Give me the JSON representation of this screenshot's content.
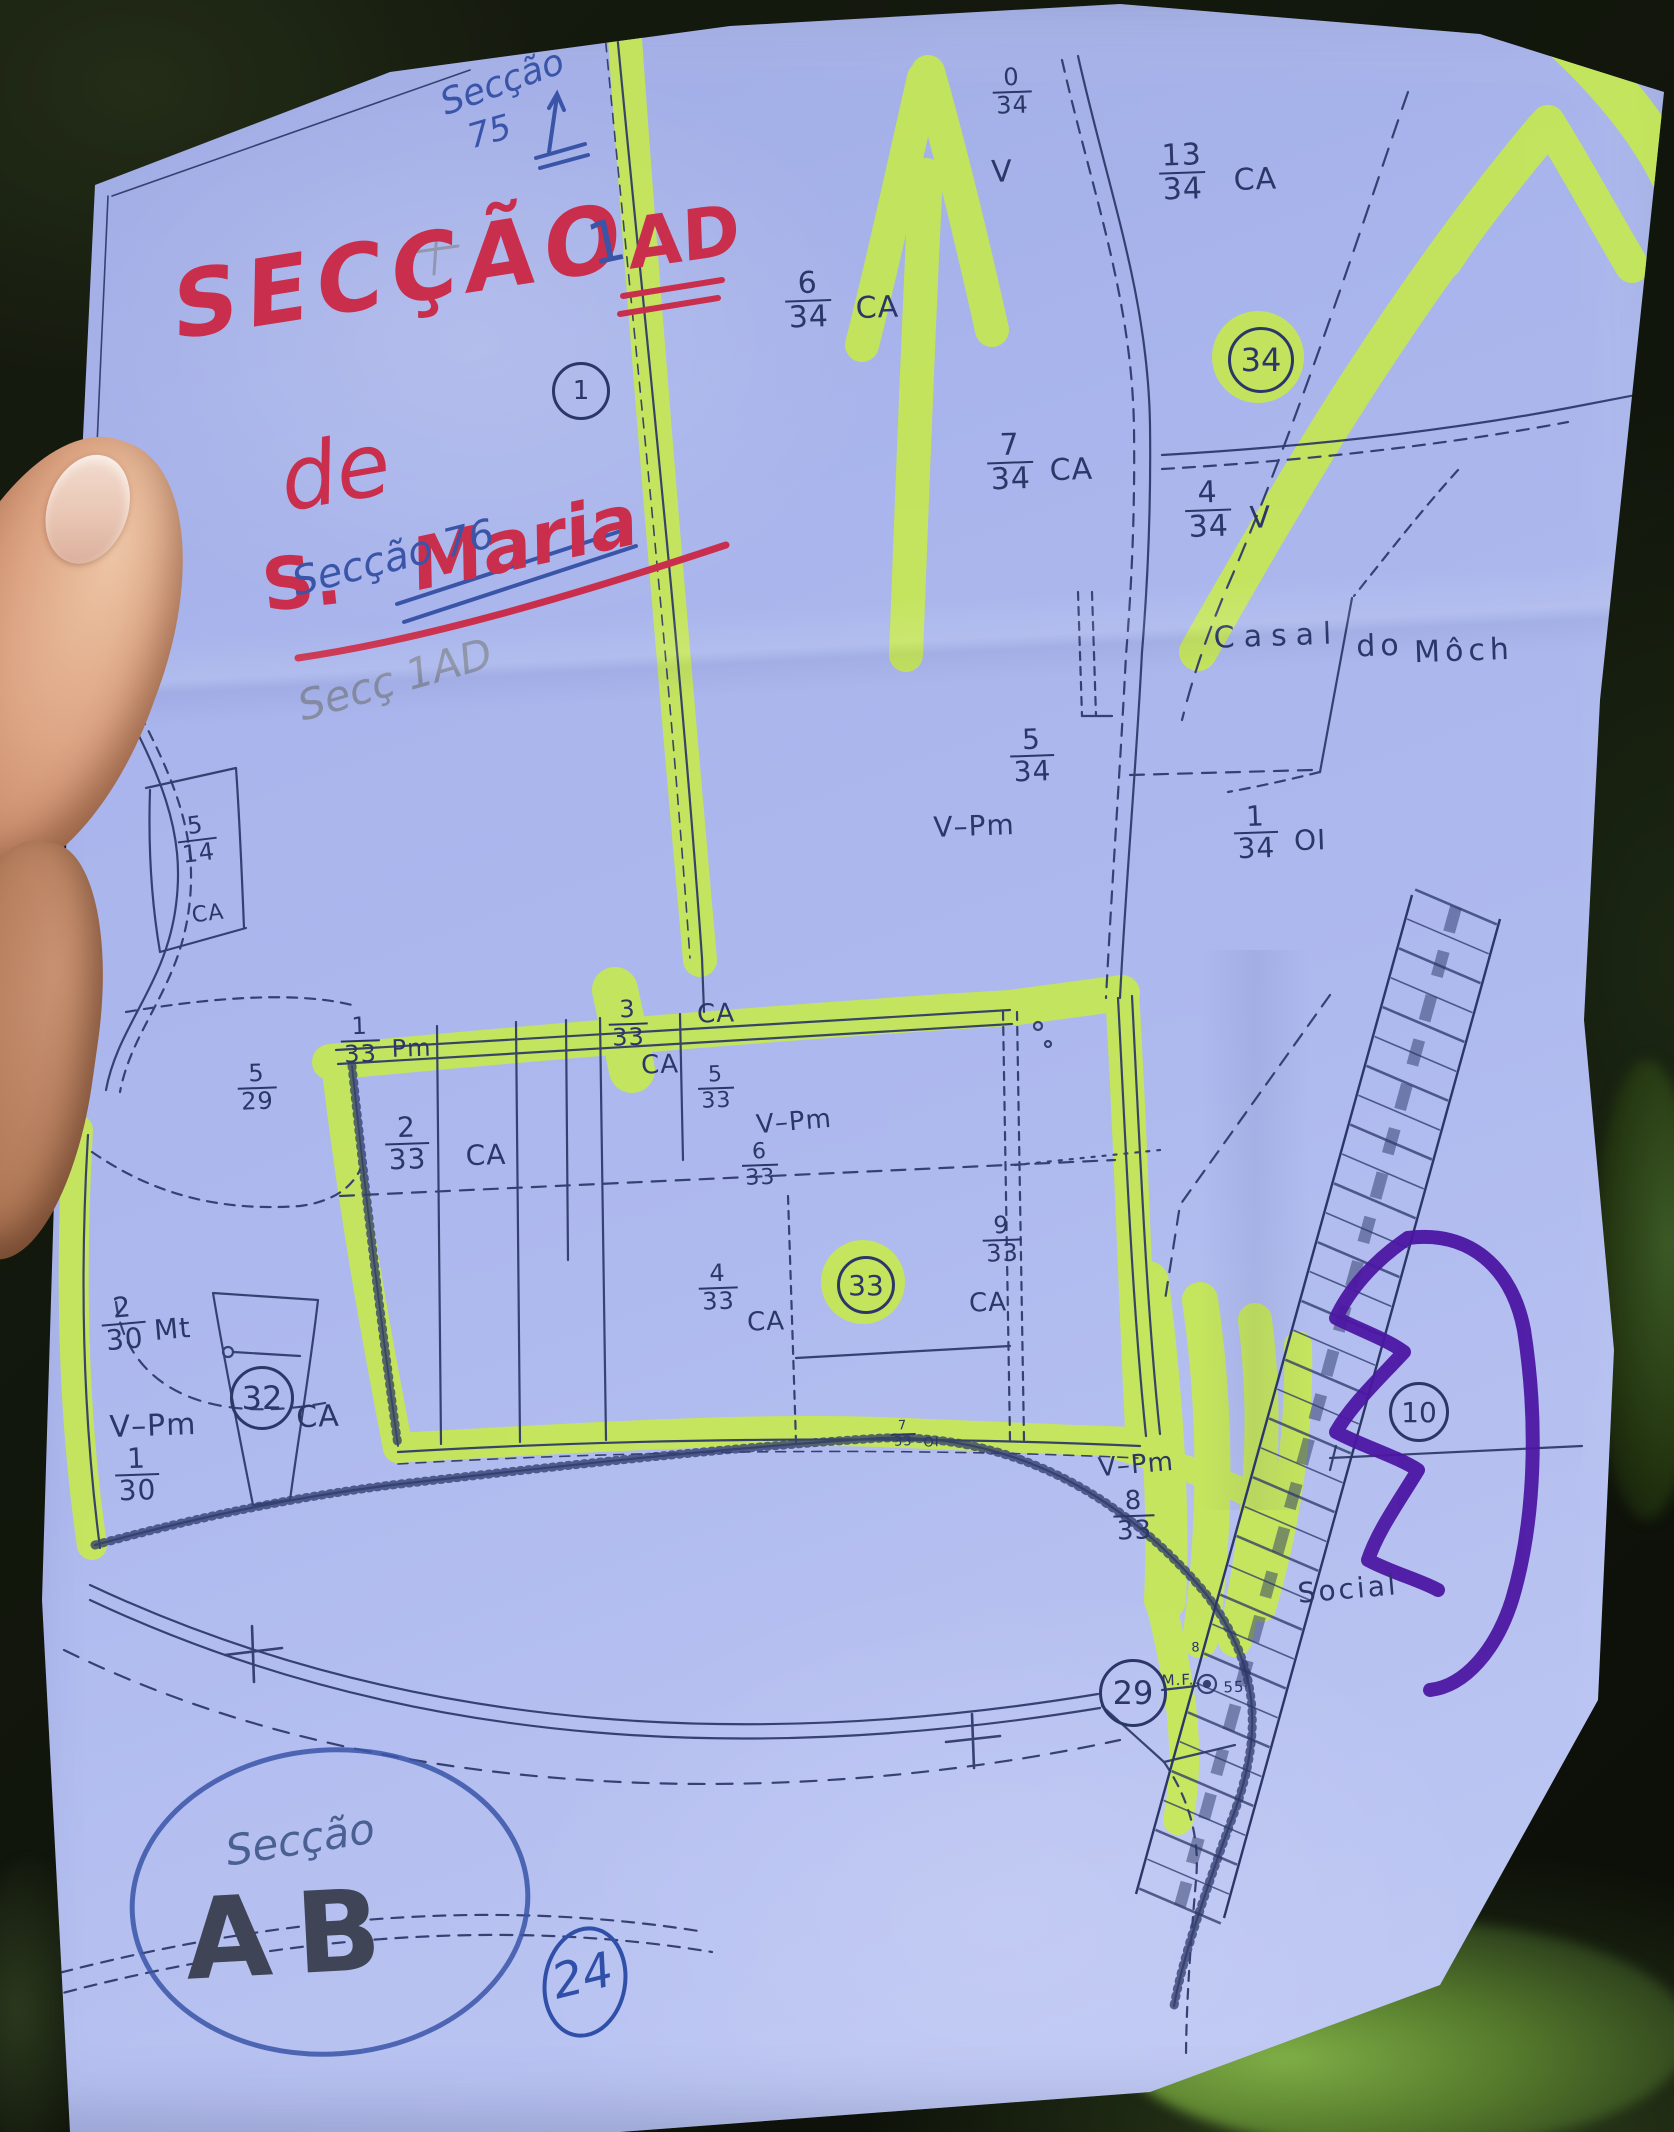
{
  "scene": {
    "description": "hand holding paper cadastral map photographed outdoors",
    "colors": {
      "paper": "#aab6ee",
      "map_ink": "#2c3768",
      "highlighter": "#c9ee3f",
      "purple_marker": "#4b16a3",
      "red_pen": "#c92f4c",
      "blue_pen": "#3a55a8",
      "pencil": "#828899",
      "background_foliage": "#141a10",
      "skin": "#d9a287"
    }
  },
  "annotations": {
    "red_title": "SECÇÃO",
    "blue_one": "1",
    "red_ad": "AD",
    "red_de": "de",
    "red_s": "S.",
    "red_maria": "Maria",
    "blue_top_word": "Secção",
    "blue_top_num": "75",
    "blue_mid": "Secção 76",
    "pencil_note": "Secç 1AD",
    "bottom_secao": "Secção",
    "bottom_ab": "AB",
    "bottom_24": "24"
  },
  "map": {
    "labels": [
      {
        "n": "0",
        "d": "34",
        "x": 1012,
        "y": 92,
        "fs": 24
      },
      {
        "t": "V",
        "x": 1002,
        "y": 172,
        "fs": 30
      },
      {
        "n": "13",
        "d": "34",
        "s": "CA",
        "x": 1218,
        "y": 172,
        "fs": 30,
        "gap": 28
      },
      {
        "n": "6",
        "d": "34",
        "s": "CA",
        "x": 842,
        "y": 300,
        "fs": 30,
        "gap": 24
      },
      {
        "n": "7",
        "d": "34",
        "s": "CA",
        "x": 1040,
        "y": 462,
        "fs": 30,
        "gap": 16
      },
      {
        "n": "4",
        "d": "34",
        "s": "V",
        "x": 1228,
        "y": 510,
        "fs": 30,
        "gap": 18
      },
      {
        "n": "5",
        "d": "34",
        "x": 1032,
        "y": 756,
        "fs": 28
      },
      {
        "t": "V–Pm",
        "x": 974,
        "y": 826,
        "fs": 28
      },
      {
        "n": "1",
        "d": "34",
        "s": "OI",
        "x": 1280,
        "y": 832,
        "fs": 28,
        "gap": 16
      },
      {
        "n": "5",
        "d": "14",
        "x": 197,
        "y": 840,
        "fs": 24,
        "rot": -7
      },
      {
        "t": "CA",
        "x": 208,
        "y": 914,
        "fs": 22,
        "rot": -7
      },
      {
        "n": "5",
        "d": "29",
        "x": 257,
        "y": 1088,
        "fs": 24
      },
      {
        "n": "1",
        "d": "33",
        "s": "Pm",
        "x": 386,
        "y": 1040,
        "fs": 24,
        "gap": 12
      },
      {
        "n": "2",
        "d": "33",
        "x": 407,
        "y": 1144,
        "fs": 28
      },
      {
        "t": "CA",
        "x": 486,
        "y": 1155,
        "fs": 28
      },
      {
        "n": "3",
        "d": "33",
        "x": 628,
        "y": 1024,
        "fs": 24
      },
      {
        "t": "CA",
        "x": 716,
        "y": 1014,
        "fs": 26
      },
      {
        "t": "CA",
        "x": 660,
        "y": 1065,
        "fs": 26
      },
      {
        "n": "5",
        "d": "33",
        "x": 716,
        "y": 1088,
        "fs": 22
      },
      {
        "t": "V–Pm",
        "x": 794,
        "y": 1122,
        "fs": 26,
        "rot": -5
      },
      {
        "n": "6",
        "d": "33",
        "x": 760,
        "y": 1165,
        "fs": 22
      },
      {
        "n": "9",
        "d": "33",
        "x": 1002,
        "y": 1240,
        "fs": 24
      },
      {
        "t": "CA",
        "x": 988,
        "y": 1303,
        "fs": 26
      },
      {
        "n": "4",
        "d": "33",
        "x": 718,
        "y": 1288,
        "fs": 24
      },
      {
        "t": "CA",
        "x": 766,
        "y": 1322,
        "fs": 26
      },
      {
        "n": "7",
        "d": "33",
        "s": "OI",
        "x": 915,
        "y": 1434,
        "fs": 13,
        "gap": 8
      },
      {
        "t": "V–Pm",
        "x": 1136,
        "y": 1465,
        "fs": 26,
        "rot": -5
      },
      {
        "n": "8",
        "d": "33",
        "x": 1134,
        "y": 1516,
        "fs": 26
      },
      {
        "n": "2",
        "d": "30",
        "s": "Mt",
        "x": 146,
        "y": 1322,
        "fs": 28,
        "gap": 8,
        "rot": -5
      },
      {
        "t": "CA",
        "x": 318,
        "y": 1417,
        "fs": 30
      },
      {
        "t": "V–Pm",
        "x": 153,
        "y": 1426,
        "fs": 30
      },
      {
        "n": "1",
        "d": "30",
        "x": 137,
        "y": 1475,
        "fs": 28
      },
      {
        "t": "Social",
        "x": 1348,
        "y": 1589,
        "fs": 28,
        "ls": 3,
        "rot": -5
      },
      {
        "t": "M.F.",
        "x": 1178,
        "y": 1680,
        "fs": 15
      },
      {
        "t": "55",
        "x": 1234,
        "y": 1687,
        "fs": 15
      },
      {
        "t": "8",
        "x": 1196,
        "y": 1648,
        "fs": 13
      }
    ],
    "circled_numbers": [
      {
        "v": "1",
        "x": 578,
        "y": 388,
        "r": 26,
        "fs": 26
      },
      {
        "v": "34",
        "x": 1258,
        "y": 357,
        "r": 30,
        "fs": 32
      },
      {
        "v": "33",
        "x": 863,
        "y": 1282,
        "r": 26,
        "fs": 28
      },
      {
        "v": "32",
        "x": 259,
        "y": 1395,
        "r": 29,
        "fs": 32
      },
      {
        "v": "10",
        "x": 1416,
        "y": 1409,
        "r": 27,
        "fs": 28
      },
      {
        "v": "29",
        "x": 1130,
        "y": 1690,
        "r": 31,
        "fs": 32
      }
    ],
    "place_names": [
      {
        "t": "Casal",
        "x": 1277,
        "y": 636,
        "ls": 9,
        "fs": 30
      },
      {
        "t": "do",
        "x": 1380,
        "y": 646,
        "ls": 5,
        "fs": 30
      },
      {
        "t": "Môch",
        "x": 1464,
        "y": 651,
        "ls": 5,
        "fs": 30
      }
    ]
  }
}
